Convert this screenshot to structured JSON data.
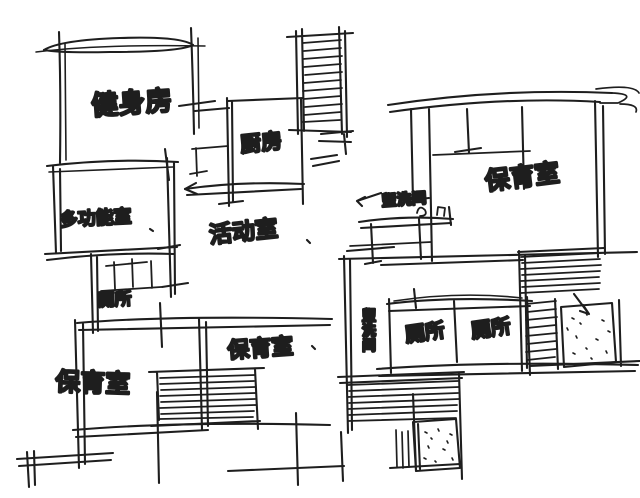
{
  "canvas": {
    "width": 640,
    "height": 498,
    "ink_color": "#1e1e1e",
    "paper_color": "#ffffff"
  },
  "sketch_type": "hand-drawn kindergarten floor plan",
  "rooms": {
    "gym": {
      "label": "健身房"
    },
    "kitchen": {
      "label": "厨房"
    },
    "multi_function": {
      "label": "多功能室"
    },
    "activity": {
      "label": "活动室"
    },
    "washroom_upper": {
      "label": "盥洗间"
    },
    "nursery_right": {
      "label": "保育室"
    },
    "toilet_left": {
      "label": "厕所"
    },
    "nursery_lower_left": {
      "label": "保育室"
    },
    "nursery_lower_center": {
      "label": "保育室"
    },
    "washroom_lower": {
      "label": "盥洗间"
    },
    "toilet_center_left": {
      "label": "厕所"
    },
    "toilet_center_right": {
      "label": "厕所"
    }
  },
  "symbols": {
    "hatched_strips": "staircase-symbol",
    "stippled_boxes": "sand-pool-symbol",
    "tick_rows": "toilet-fixture-symbol",
    "counter_with_taps": "washstand-symbol"
  }
}
